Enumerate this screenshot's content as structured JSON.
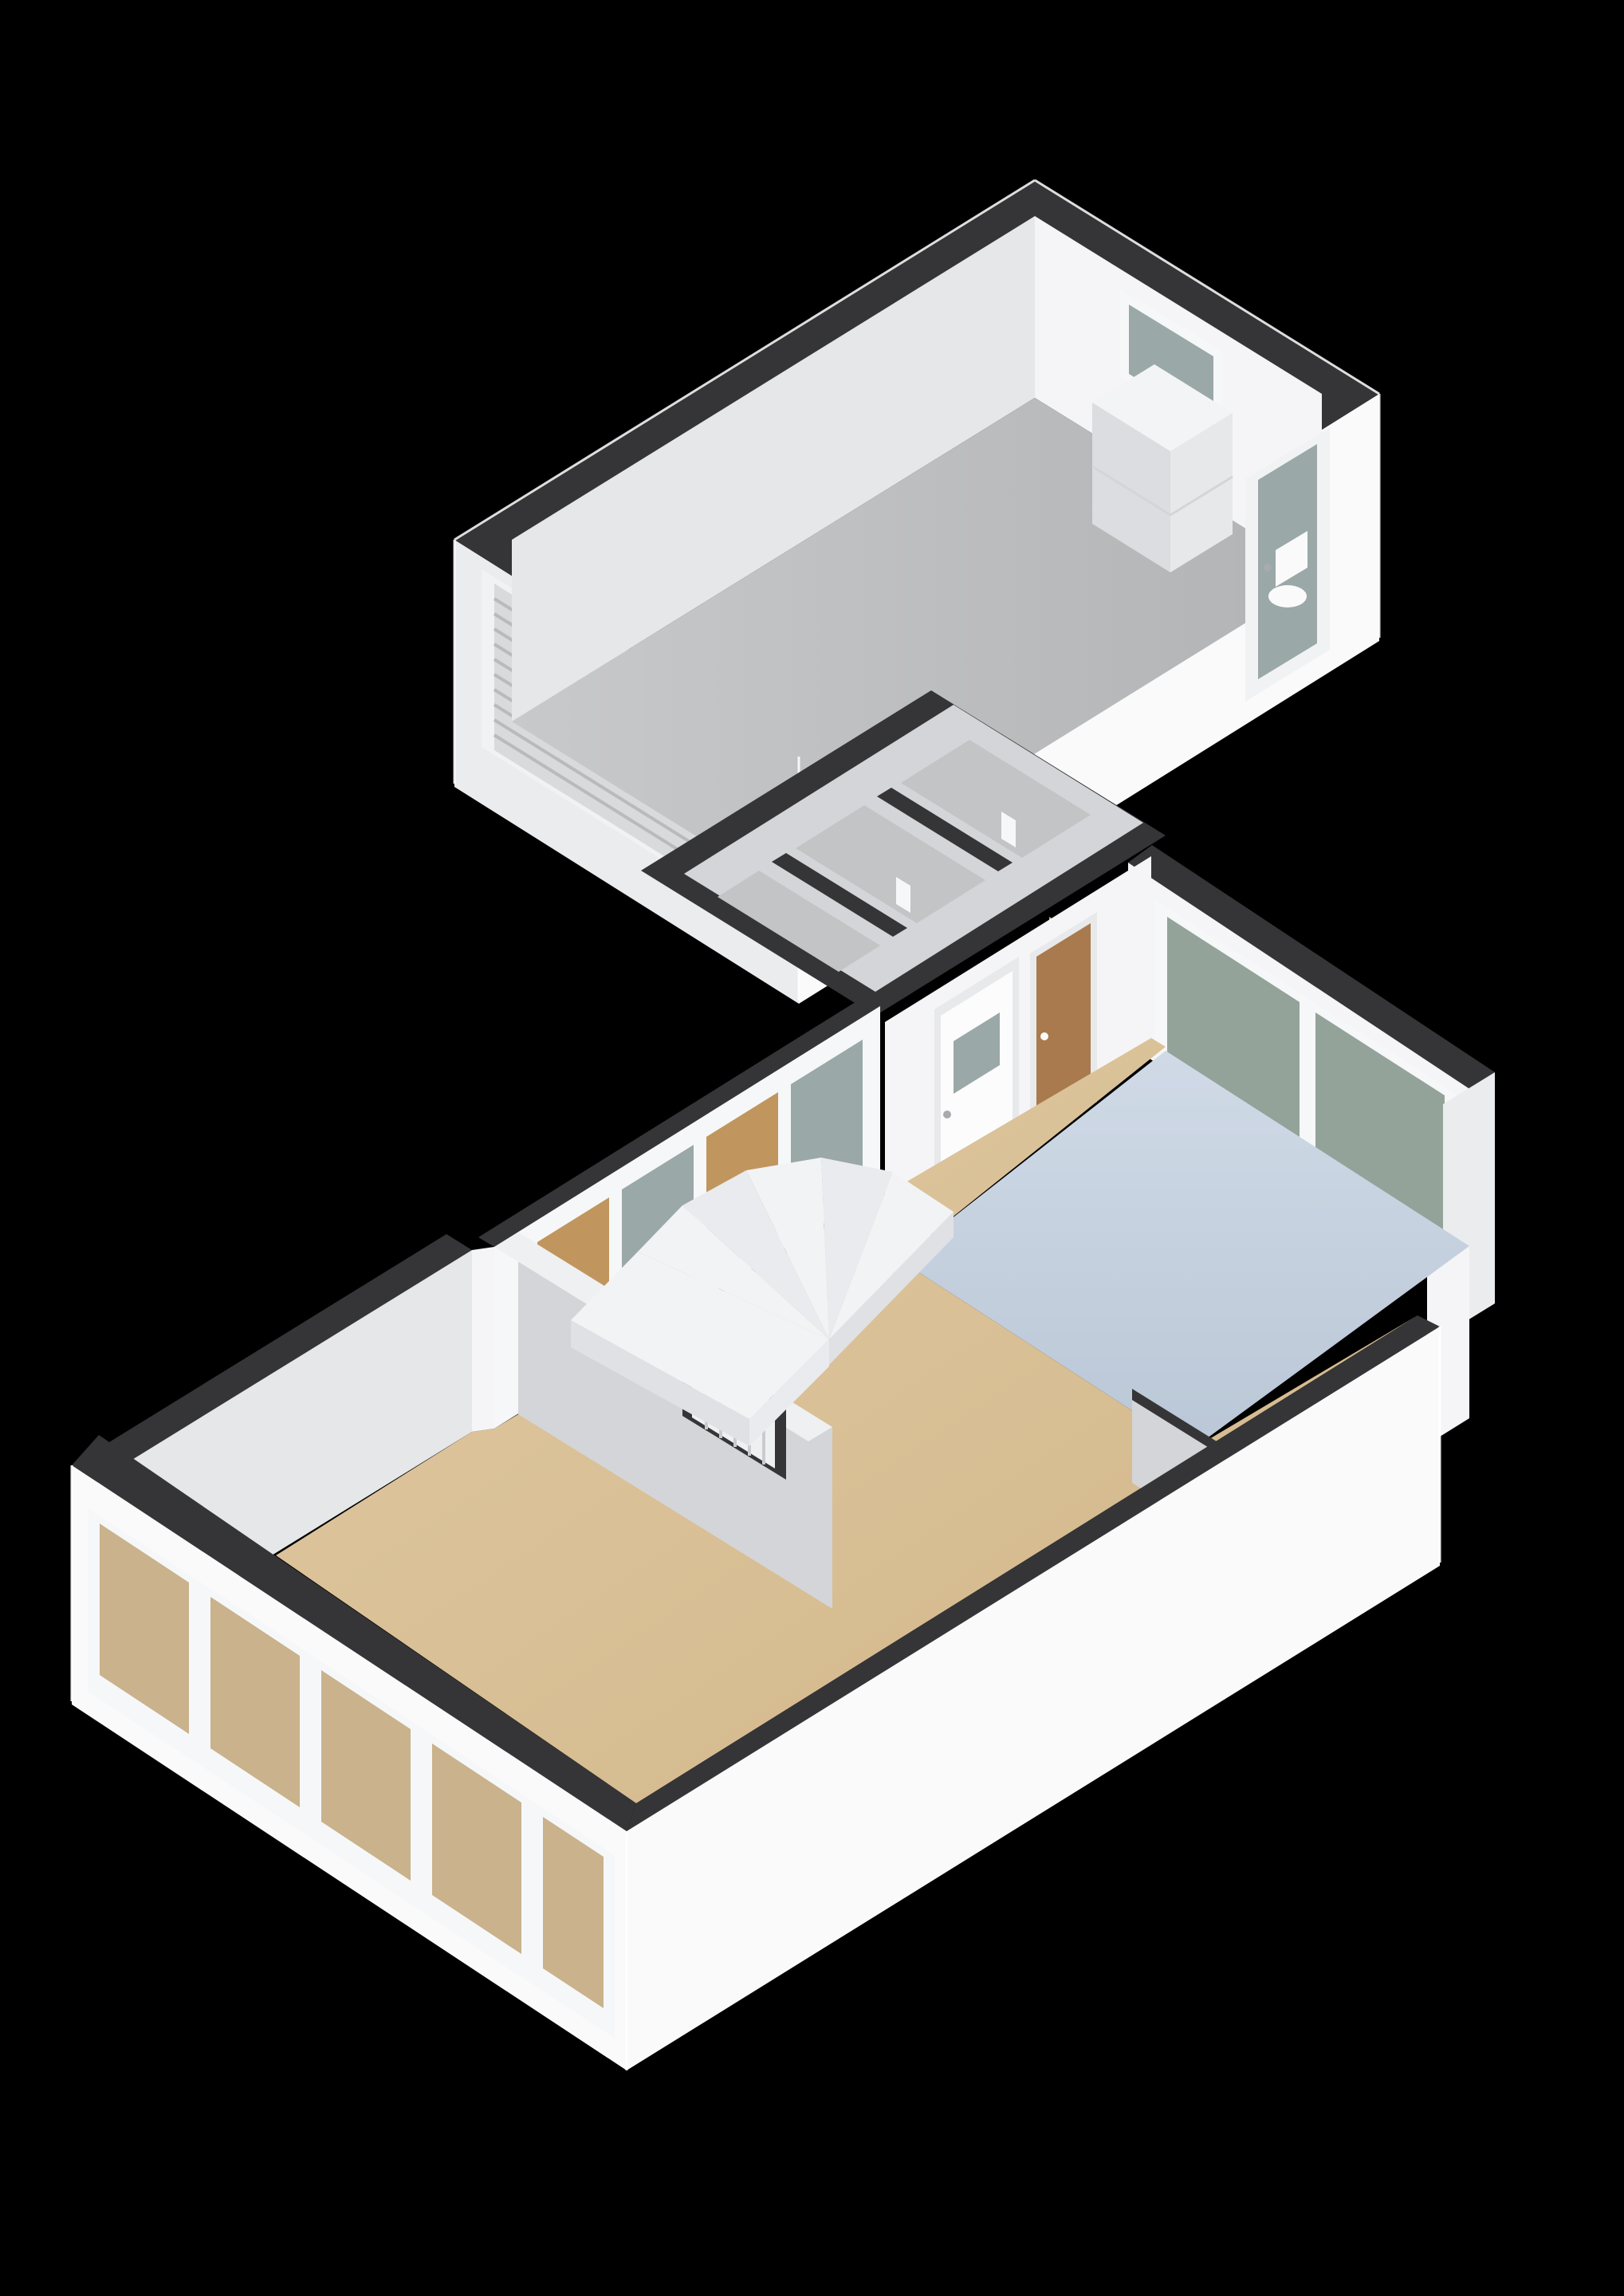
{
  "app": {
    "type": "3d-floorplan-cutaway-render",
    "view": "isometric",
    "background": "#000000"
  },
  "scene": {
    "rooms": [
      {
        "name": "garage",
        "floor": "gray",
        "fixtures": [
          "roll-up-garage-door",
          "high-small-window",
          "boiler-unit",
          "toilet",
          "glazed-exterior-door"
        ]
      },
      {
        "name": "entrance-hall",
        "floor": "wood",
        "fixtures": [
          "winder-staircase",
          "front-door-with-glass",
          "wood-interior-door",
          "glazed-side-panels"
        ]
      },
      {
        "name": "corridor-with-storage",
        "floor": "gray",
        "fixtures": [
          "door-openings"
        ]
      },
      {
        "name": "kitchen",
        "floor": "light-blue",
        "fixtures": [
          "double-window",
          "half-wall",
          "flue-pipe"
        ]
      },
      {
        "name": "living-room",
        "floor": "wood",
        "fixtures": [
          "window-wall",
          "radiator-niche"
        ]
      }
    ]
  },
  "palette": {
    "bg": "#000000",
    "wallTop": "#353537",
    "wallTopLight": "#eff0f2",
    "intBright": "#f5f5f7",
    "intLight": "#e6e7e9",
    "intMid": "#d4d5d8",
    "extWall": "#fafafb",
    "extShade": "#ebecee",
    "floorGarageA": "#c8c9cb",
    "floorGarageB": "#b2b3b5",
    "floorGray": "#c3c4c6",
    "floorWoodA": "#e0c9a2",
    "floorWoodB": "#d2b689",
    "floorKitchenA": "#d0dae7",
    "floorKitchenB": "#bac7d6",
    "glassGray": "#9aa8a8",
    "glassGreen": "#93a39a",
    "glassTan": "#c0965e",
    "glassThrough": "#c9b28c",
    "winFrame": "#f6f7f8",
    "doorWhite": "#fcfcfd",
    "doorFrame": "#e8e9eb",
    "woodDoor": "#a87a4e",
    "stairA": "#f2f3f5",
    "stairB": "#e9ebee",
    "stairFace": "#dfe1e4",
    "boilerTop": "#f3f4f5",
    "boilerSide": "#e7e8ea",
    "boilerFront": "#dcdde0",
    "flue": "#17181a",
    "flueInner": "#0a0a0b",
    "radiator": "#eef0f2",
    "radiatorSlat": "#c9cbcf",
    "edge": "#ffffff",
    "garageDoor": "#d9dadc",
    "garageDoorRib": "#b9babd",
    "frame": "#f1f2f3",
    "handle": "#a9aaad",
    "toilet": "#fafafa"
  }
}
